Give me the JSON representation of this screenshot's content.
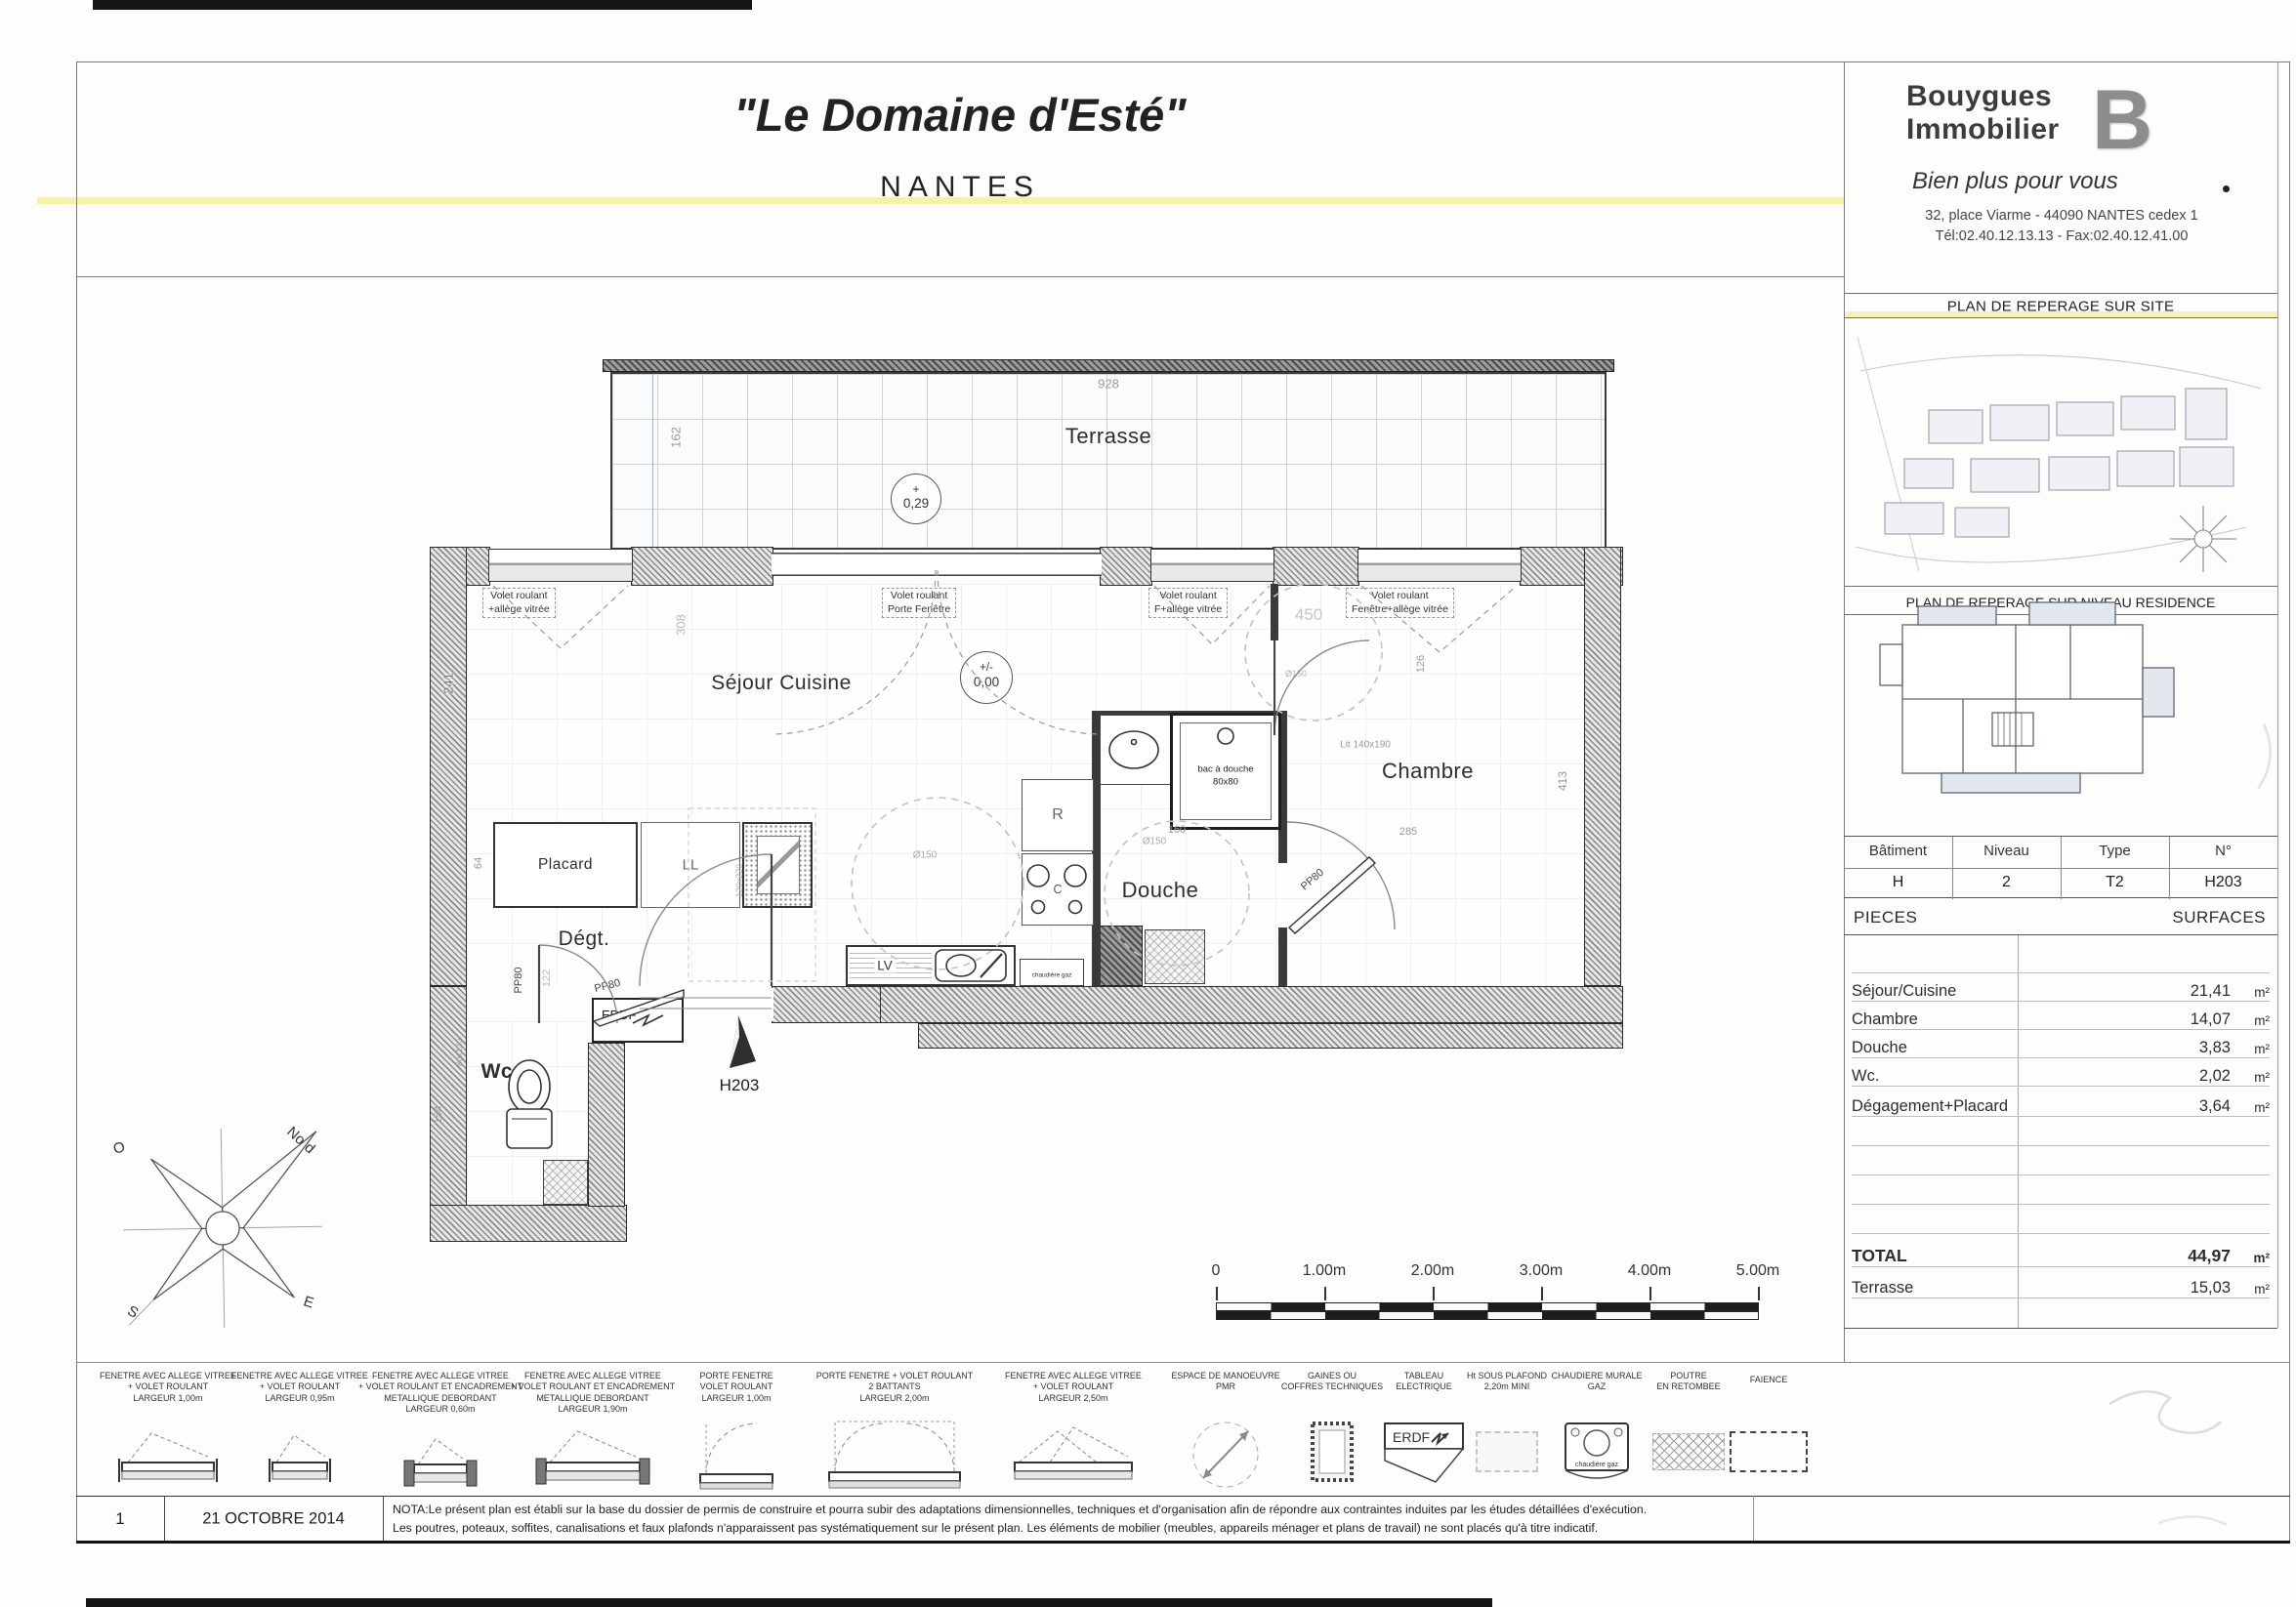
{
  "sheet": {
    "title": "\"Le Domaine d'Esté\"",
    "city": "NANTES"
  },
  "brand": {
    "line1": "Bouygues",
    "line2": "Immobilier",
    "logo": "B",
    "tagline": "Bien plus pour vous",
    "address": "32, place Viarme - 44090 NANTES cedex 1",
    "contact": "Tél:02.40.12.13.13 - Fax:02.40.12.41.00"
  },
  "panels": {
    "site_title": "PLAN DE REPERAGE SUR SITE",
    "residence_title": "PLAN DE REPERAGE SUR NIVEAU RESIDENCE",
    "residence_unit": "H203"
  },
  "unit_table": {
    "headers": [
      "Bâtiment",
      "Niveau",
      "Type",
      "N°"
    ],
    "values": [
      "H",
      "2",
      "T2",
      "H203"
    ]
  },
  "surfaces": {
    "pieces": "PIECES",
    "surfaces_label": "SURFACES",
    "rows": [
      {
        "label": "Séjour/Cuisine",
        "value": "21,41",
        "unit": "m²"
      },
      {
        "label": "Chambre",
        "value": "14,07",
        "unit": "m²"
      },
      {
        "label": "Douche",
        "value": "3,83",
        "unit": "m²"
      },
      {
        "label": "Wc.",
        "value": "2,02",
        "unit": "m²"
      },
      {
        "label": "Dégagement+Placard",
        "value": "3,64",
        "unit": "m²"
      }
    ],
    "total": {
      "label": "TOTAL",
      "value": "44,97",
      "unit": "m²"
    },
    "terrasse": {
      "label": "Terrasse",
      "value": "15,03",
      "unit": "m²"
    }
  },
  "plan": {
    "rooms": {
      "terrasse": "Terrasse",
      "sejour": "Séjour Cuisine",
      "chambre": "Chambre",
      "douche": "Douche",
      "wc": "Wc.",
      "degt": "Dégt.",
      "placard": "Placard"
    },
    "levels": {
      "terrace_sign": "+",
      "terrace": "0,29",
      "floor_sign": "+/-",
      "floor": "0,00"
    },
    "fixtures": {
      "ll": "LL",
      "lv": "LV",
      "fridge": "R",
      "hob": "C",
      "erdf": "ERDF",
      "bac_line1": "bac à douche",
      "bac_line2": "80x80",
      "chaudiere": "chaudière gaz",
      "lit": "Lit 140x190"
    },
    "doors": {
      "pp80": "PP80"
    },
    "entry_unit": "H203",
    "callouts": [
      {
        "line1": "Volet roulant",
        "line2": "+allège vitrée"
      },
      {
        "line1": "Volet roulant",
        "line2": "Porte Fenêtre"
      },
      {
        "line1": "Volet roulant",
        "line2": "F+allège vitrée"
      },
      {
        "line1": "Volet roulant",
        "line2": "Fenêtre+allège vitrée"
      }
    ],
    "dims": {
      "w928": "928",
      "h162": "162",
      "h241": "241",
      "h308": "308",
      "w450": "450",
      "h413": "413",
      "h126": "126",
      "w285": "285",
      "w160": "160",
      "h64": "64",
      "h122": "122",
      "h154": "154",
      "fx80x130": "80x130",
      "table120x220": "120x220",
      "dia150": "Ø150"
    }
  },
  "compass": {
    "nord": "Nord",
    "o": "O",
    "s": "S",
    "e": "E"
  },
  "scale_bar": {
    "ticks": [
      "0",
      "1.00m",
      "2.00m",
      "3.00m",
      "4.00m",
      "5.00m"
    ]
  },
  "legend": {
    "erdf": "ERDF",
    "chaudiere": "chaudière gaz",
    "items": [
      {
        "lines": [
          "FENETRE AVEC ALLEGE VITREE",
          "+ VOLET ROULANT",
          "LARGEUR 1,00m"
        ]
      },
      {
        "lines": [
          "FENETRE AVEC ALLEGE VITREE",
          "+ VOLET ROULANT",
          "LARGEUR 0,95m"
        ]
      },
      {
        "lines": [
          "FENETRE AVEC ALLEGE VITREE",
          "+ VOLET ROULANT ET ENCADREMENT",
          "METALLIQUE DEBORDANT",
          "LARGEUR 0,60m"
        ]
      },
      {
        "lines": [
          "FENETRE AVEC ALLEGE VITREE",
          "+ VOLET ROULANT ET ENCADREMENT",
          "METALLIQUE DEBORDANT",
          "LARGEUR 1,90m"
        ]
      },
      {
        "lines": [
          "PORTE FENETRE",
          "VOLET ROULANT",
          "LARGEUR 1,00m"
        ]
      },
      {
        "lines": [
          "PORTE FENETRE + VOLET ROULANT",
          "2 BATTANTS",
          "LARGEUR 2,00m"
        ]
      },
      {
        "lines": [
          "FENETRE AVEC ALLEGE VITREE",
          "+ VOLET ROULANT",
          "LARGEUR 2,50m"
        ]
      },
      {
        "lines": [
          "ESPACE DE MANOEUVRE",
          "PMR"
        ]
      },
      {
        "lines": [
          "GAINES OU",
          "COFFRES TECHNIQUES"
        ]
      },
      {
        "lines": [
          "TABLEAU",
          "ELECTRIQUE"
        ]
      },
      {
        "lines": [
          "Ht SOUS PLAFOND",
          "2,20m MINI"
        ]
      },
      {
        "lines": [
          "CHAUDIERE MURALE",
          "GAZ"
        ]
      },
      {
        "lines": [
          "POUTRE",
          "EN RETOMBEE"
        ]
      },
      {
        "lines": [
          "FAIENCE"
        ]
      }
    ]
  },
  "footer": {
    "rev": "1",
    "date": "21 OCTOBRE 2014",
    "nota1": "NOTA:Le présent plan est établi sur la base du dossier de permis de construire et pourra subir des adaptations dimensionnelles, techniques et d'organisation afin de répondre aux contraintes induites par les études détaillées d'exécution.",
    "nota2": "Les poutres, poteaux, soffites, canalisations et faux plafonds n'apparaissent pas systématiquement sur le présent plan. Les éléments de mobilier (meubles, appareils ménager et plans de travail) ne sont placés qu'à titre indicatif."
  }
}
